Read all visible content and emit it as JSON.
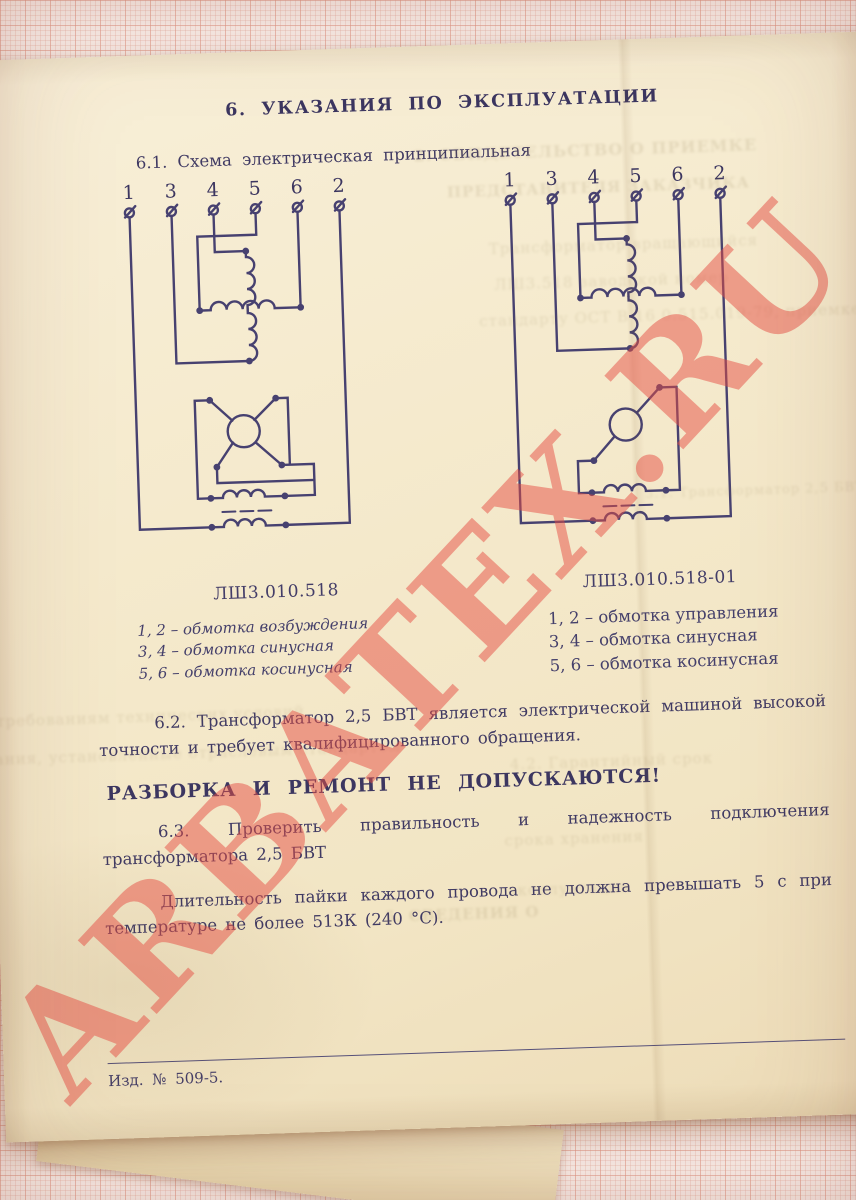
{
  "page": {
    "title": "6. УКАЗАНИЯ ПО ЭКСПЛУАТАЦИИ",
    "section_61": "6.1. Схема электрическая принципиальная",
    "para_62": "6.2. Трансформатор 2,5 БВТ является электрической машиной высокой точности и требует квалифицированного обращения.",
    "warning": "РАЗБОРКА И РЕМОНТ НЕ ДОПУСКАЮТСЯ!",
    "para_63": "6.3. Проверить правильность и надежность подключения трансформатора 2,5 БВТ",
    "para_solder": "Длительность пайки каждого провода не должна превышать 5 с при температуре не более 513К (240 °С).",
    "footer": "Изд.  № 509-5."
  },
  "diagrams": {
    "left": {
      "caption": "ЛШ3.010.518",
      "terminals": [
        "1",
        "3",
        "4",
        "5",
        "6",
        "2"
      ],
      "legend": [
        "1, 2 – обмотка возбуждения",
        "3, 4 – обмотка синусная",
        "5, 6 – обмотка косинусная"
      ]
    },
    "right": {
      "caption": "ЛШ3.010.518-01",
      "terminals": [
        "1",
        "3",
        "4",
        "5",
        "6",
        "2"
      ],
      "legend": [
        "1, 2 – обмотка управления",
        "3, 4 – обмотка синусная",
        "5, 6 – обмотка косинусная"
      ]
    }
  },
  "watermark": {
    "text": "ARBATEX.RU",
    "color": "#e54d44"
  },
  "bleedthrough": {
    "lines": [
      "2. СВИДЕТЕЛЬСТВО О ПРИЕМКЕ",
      "ПРЕДСТАВИТЕЛЯ ЗАКАЗЧИКА",
      "Трансформатор вращающийся",
      "ЛШ3.518  заводской номер",
      "стандарту ОСТ В 16 0.515.019-79, приемке",
      "3.1. Трансформатор 2,5 БВТ",
      "требованиям технических условий",
      "тания, установленные отраслевым стандартом",
      "4.2. Гарантийный срок",
      "срока хранения",
      "эксплуатации",
      "5. СВЕДЕНИЯ О"
    ]
  }
}
